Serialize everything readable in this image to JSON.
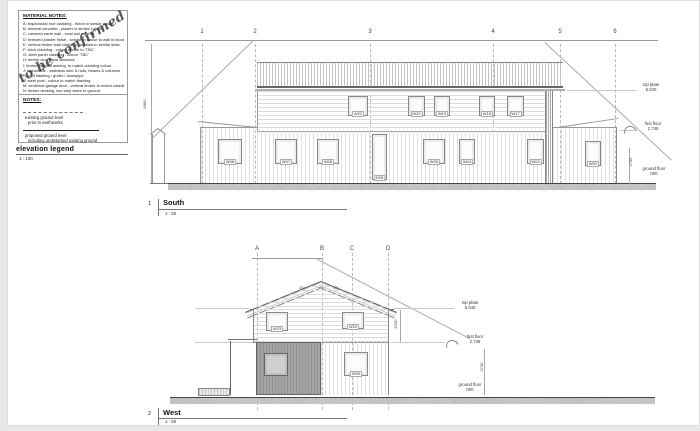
{
  "material_notes": {
    "title": "MATERIAL NOTES:",
    "items": [
      "A:  trapezoidal roof cladding - fluted in similar colour",
      "B:  mineral concrete - plaster in similar colour",
      "C:  rammed earth wall - local soil mineral",
      "D:  textured plaster finish - similar in colour to wall in blockwork",
      "E:  vertical timber wall cladding - stained in similar stain",
      "F:  brick cladding - colour similar to 'TBC'",
      "G:  steel panel cladding - colour 'TBC'",
      "H:  timber doors and windows",
      "I:  timber pergola awning, to match cladding colour",
      "J:  balustrade - stainless wire & rods, beams & columns",
      "K:  roof flashing / gutter / downpipe",
      "L:  steel post - colour to match flashing",
      "M:  sectional garage door - vertical timber to match cladding",
      "N:  timber decking, two step down to ground"
    ]
  },
  "watermark": {
    "text": "to be confirmed"
  },
  "notes": {
    "title": "NOTES:",
    "existing_label": "existing ground level",
    "existing_sub": "prior to earthworks",
    "proposed_label": "proposed ground level",
    "proposed_sub": "including undisturbed existing ground"
  },
  "legend": {
    "title": "elevation legend",
    "scale": "1 : 100"
  },
  "levels": {
    "top_plate_label": "top plate",
    "top_plate_value": "5.040",
    "first_floor_label": "first floor",
    "first_floor_value": "2.745",
    "ground_floor_label": "ground floor",
    "ground_floor_value": "000",
    "storey_dim": "2745"
  },
  "south": {
    "number": "1",
    "title": "South",
    "scale": "1 : 50",
    "grids": [
      "1",
      "2",
      "3",
      "4",
      "5",
      "6"
    ],
    "height_dim": "8460",
    "windows_upper": [
      "W21",
      "W20",
      "W19",
      "W18",
      "W17"
    ],
    "openings_ground": [
      "W08",
      "W07",
      "W06",
      "D05",
      "W05",
      "W04",
      "W03",
      "W02"
    ]
  },
  "west": {
    "number": "2",
    "title": "West",
    "scale": "1 : 50",
    "grids": [
      "A",
      "B",
      "C",
      "D"
    ],
    "pitch_left": "45°",
    "pitch_right": "45°",
    "height_dim": "5340",
    "windows_upper": [
      "W23",
      "W22"
    ],
    "openings_ground": [
      "W09"
    ]
  }
}
